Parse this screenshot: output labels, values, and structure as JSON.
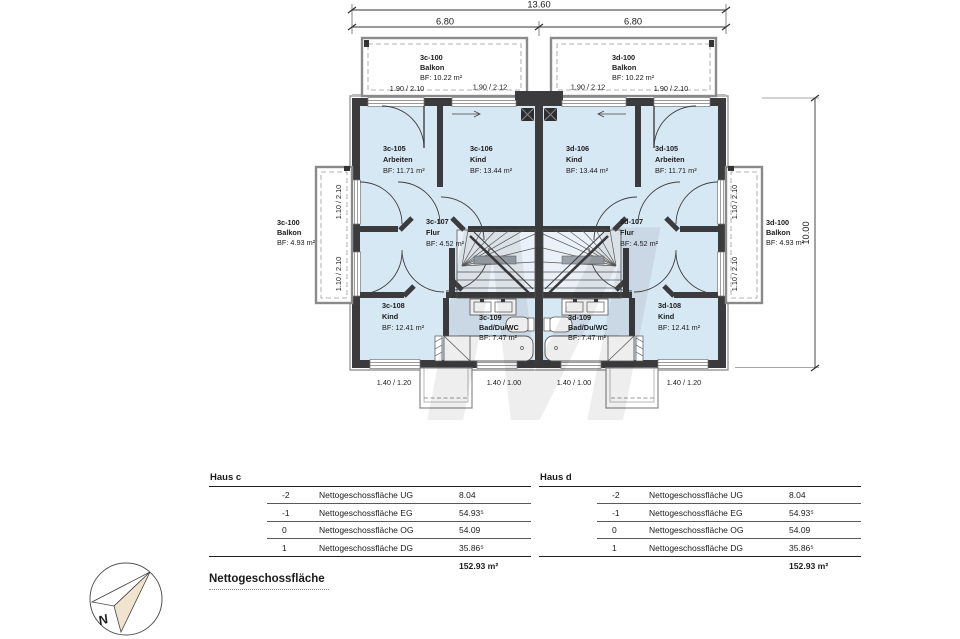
{
  "colors": {
    "room_fill": "#d7e8f5",
    "wall": "#3b3b3d",
    "accent_gray": "#9a9a9a",
    "needle_beige": "#f1e4cf"
  },
  "dimensions": {
    "total_width": "13.60",
    "left_width": "6.80",
    "right_width": "6.80",
    "height": "10.00",
    "win_top": [
      "1.90 / 2.10",
      "1.90 / 2.12",
      "1.90 / 2.12",
      "1.90 / 2.10"
    ],
    "win_left": [
      "1.10 / 2.10",
      "1.10 / 2.10"
    ],
    "win_right": [
      "1.10 / 2.10",
      "1.10 / 2.10"
    ],
    "win_bottom": [
      "1.40 / 1.20",
      "1.40 / 1.00",
      "1.40 / 1.00",
      "1.40 / 1.20"
    ]
  },
  "watermark_letter": "M",
  "rooms": {
    "balkon_c_top": {
      "id": "3c-100",
      "name": "Balkon",
      "bf": "BF: 10.22 m²"
    },
    "balkon_d_top": {
      "id": "3d-100",
      "name": "Balkon",
      "bf": "BF: 10.22 m²"
    },
    "c105": {
      "id": "3c-105",
      "name": "Arbeiten",
      "bf": "BF: 11.71 m²"
    },
    "c106": {
      "id": "3c-106",
      "name": "Kind",
      "bf": "BF: 13.44 m²"
    },
    "d106": {
      "id": "3d-106",
      "name": "Kind",
      "bf": "BF: 13.44 m²"
    },
    "d105": {
      "id": "3d-105",
      "name": "Arbeiten",
      "bf": "BF: 11.71 m²"
    },
    "c107": {
      "id": "3c-107",
      "name": "Flur",
      "bf": "BF: 4.52 m²"
    },
    "d107": {
      "id": "3d-107",
      "name": "Flur",
      "bf": "BF: 4.52 m²"
    },
    "c108": {
      "id": "3c-108",
      "name": "Kind",
      "bf": "BF: 12.41 m²"
    },
    "d108": {
      "id": "3d-108",
      "name": "Kind",
      "bf": "BF: 12.41 m²"
    },
    "c109": {
      "id": "3c-109",
      "name": "Bad/Du/WC",
      "bf": "BF: 7.47 m²"
    },
    "d109": {
      "id": "3d-109",
      "name": "Bad/Du/WC",
      "bf": "BF: 7.47 m²"
    },
    "balkon_c_side": {
      "id": "3c-100",
      "name": "Balkon",
      "bf": "BF: 4.93 m²"
    },
    "balkon_d_side": {
      "id": "3d-100",
      "name": "Balkon",
      "bf": "BF: 4.93 m²"
    }
  },
  "tables": {
    "haus_c": {
      "title": "Haus c",
      "rows": [
        {
          "level": "-2",
          "label": "Nettogeschossfläche UG",
          "value": "8.04"
        },
        {
          "level": "-1",
          "label": "Nettogeschossfläche EG",
          "value": "54.93⁵"
        },
        {
          "level": "0",
          "label": "Nettogeschossfläche OG",
          "value": "54.09"
        },
        {
          "level": "1",
          "label": "Nettogeschossfläche DG",
          "value": "35.86⁵"
        }
      ],
      "total": "152.93 m²"
    },
    "haus_d": {
      "title": "Haus d",
      "rows": [
        {
          "level": "-2",
          "label": "Nettogeschossfläche UG",
          "value": "8.04"
        },
        {
          "level": "-1",
          "label": "Nettogeschossfläche EG",
          "value": "54.93⁵"
        },
        {
          "level": "0",
          "label": "Nettogeschossfläche OG",
          "value": "54.09"
        },
        {
          "level": "1",
          "label": "Nettogeschossfläche DG",
          "value": "35.86⁵"
        }
      ],
      "total": "152.93 m²"
    }
  },
  "footer": {
    "title": "Nettogeschossfläche"
  },
  "compass": {
    "north_label": "N"
  }
}
